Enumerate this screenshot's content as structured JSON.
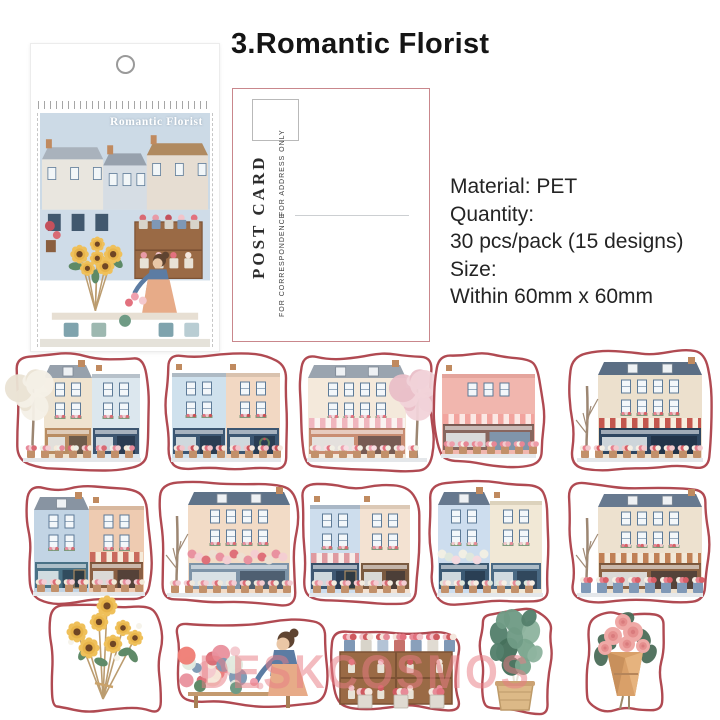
{
  "header": {
    "title": "3.Romantic Florist"
  },
  "package": {
    "label": "Romantic Florist",
    "sky_color": "#ccdae6"
  },
  "postcard": {
    "title": "POST CARD",
    "address_note": "FOR ADDRESS ONLY",
    "correspondence_note": "FOR CORRESPONDENCE",
    "border_color": "#c9878c"
  },
  "details": {
    "material": "Material: PET",
    "quantity_label": "Quantity:",
    "quantity_value": "30 pcs/pack (15 designs)",
    "size_label": "Size:",
    "size_value": "Within 60mm x 60mm"
  },
  "watermark": {
    "text": "DESKCOSMOS",
    "color": "#e87d84"
  },
  "stickers": {
    "outline_color": "#b04a52",
    "items": [
      {
        "name": "flower-shop-white-blossom-tree",
        "type": "shop",
        "x": 12,
        "y": 350,
        "w": 140,
        "h": 124,
        "seed": 1,
        "buildings": [
          {
            "c": "#efe3cf",
            "roof": "mansard",
            "rc": "#97a1ac"
          },
          {
            "c": "#dce7ee",
            "roof": "flat",
            "rc": "#b7c1ca"
          }
        ],
        "shops": [
          "#b98d63",
          "#3d5570"
        ],
        "tree": {
          "type": "white",
          "side": "left"
        },
        "flowers": [
          "#e78b9b",
          "#f4cdd2",
          "#d96a74",
          "#f6ead9",
          "#eef0e8"
        ]
      },
      {
        "name": "twin-storefronts-wreath-door",
        "type": "shop",
        "x": 160,
        "y": 349,
        "w": 132,
        "h": 125,
        "seed": 2,
        "buildings": [
          {
            "c": "#cfe1ed",
            "roof": "flat",
            "rc": "#aebac4"
          },
          {
            "c": "#f2d8c3",
            "roof": "flat",
            "rc": "#d9c2ae"
          }
        ],
        "shops": [
          "#3c5672",
          "#3c5672"
        ],
        "wreath": true,
        "flowers": [
          "#e2717e",
          "#f2c3c9",
          "#ca4f55",
          "#f4e6dd"
        ]
      },
      {
        "name": "pink-awning-shop-blossom-tree",
        "type": "shop",
        "x": 296,
        "y": 350,
        "w": 142,
        "h": 124,
        "seed": 3,
        "buildings": [
          {
            "c": "#f4e9db",
            "roof": "mansard",
            "rc": "#9aa4af"
          }
        ],
        "shops": [
          "#c98d72"
        ],
        "awnings": [
          [
            "#f0b6be",
            "#faf3f0"
          ]
        ],
        "tree": {
          "type": "blossom",
          "side": "right"
        },
        "flowers": [
          "#ef9fae",
          "#f7dde2",
          "#e4717f",
          "#f2efe4"
        ]
      },
      {
        "name": "pink-facade-flower-boutique",
        "type": "shop",
        "x": 430,
        "y": 350,
        "w": 117,
        "h": 120,
        "seed": 4,
        "buildings": [
          {
            "c": "#f1b6ae",
            "roof": "flat",
            "rc": "#e4a49c"
          }
        ],
        "shops": [
          "#88665e"
        ],
        "awnings": [
          [
            "#f2a49e",
            "#fbe8e4"
          ]
        ],
        "doorColor": "#8095aa",
        "flowers": [
          "#f3c9cd",
          "#ee9daa",
          "#f7efe6",
          "#e88795"
        ]
      },
      {
        "name": "red-striped-awning-flower-stall",
        "type": "shop",
        "x": 566,
        "y": 347,
        "w": 148,
        "h": 127,
        "seed": 5,
        "buildings": [
          {
            "c": "#ece0cd",
            "roof": "mansard",
            "rc": "#5b6e84"
          }
        ],
        "shops": [
          "#2e4660"
        ],
        "awnings": [
          [
            "#c4574e",
            "#f6eedf"
          ]
        ],
        "tree": {
          "type": "bare",
          "side": "left"
        },
        "flowers": [
          "#e8828f",
          "#f3c9cc",
          "#d95f66",
          "#f5efe4"
        ]
      },
      {
        "name": "blue-peach-shops-chalkboard",
        "type": "shop",
        "x": 22,
        "y": 482,
        "w": 134,
        "h": 126,
        "seed": 6,
        "buildings": [
          {
            "c": "#c2d4e4",
            "roof": "mansard",
            "rc": "#8894a2"
          },
          {
            "c": "#eecbb1",
            "roof": "flat",
            "rc": "#d8b89e"
          }
        ],
        "shops": [
          "#4a7286",
          "#8a5f43"
        ],
        "awnings": [
          null,
          [
            "#c96a5d",
            "#f5ead9"
          ]
        ],
        "chalkboard": true,
        "flowers": [
          "#e88e9e",
          "#f3cdd3",
          "#dd6b76",
          "#f2ead9"
        ]
      },
      {
        "name": "peach-townhouse-rose-canopy",
        "type": "shop",
        "x": 156,
        "y": 477,
        "w": 146,
        "h": 132,
        "seed": 7,
        "buildings": [
          {
            "c": "#f2dbc6",
            "roof": "mansard",
            "rc": "#5f7389"
          }
        ],
        "shops": [
          "#7e94a8"
        ],
        "roseband": true,
        "rosebandColors": [
          "#e88e9e",
          "#f3cdd3",
          "#dd6b76",
          "#ecdfd2"
        ],
        "tree": {
          "type": "bare",
          "side": "left"
        },
        "flowers": [
          "#e88e9e",
          "#f3cdd3",
          "#dd6b76",
          "#f0e9dc"
        ]
      },
      {
        "name": "blue-shop-pink-awning-menu-board",
        "type": "shop",
        "x": 298,
        "y": 481,
        "w": 124,
        "h": 128,
        "seed": 8,
        "buildings": [
          {
            "c": "#cddded",
            "roof": "flat",
            "rc": "#a9b7c6"
          },
          {
            "c": "#f3e2d2",
            "roof": "flat",
            "rc": "#dcc9b6"
          }
        ],
        "shops": [
          "#3f5873",
          "#7a5a40"
        ],
        "awnings": [
          [
            "#df9aa0",
            "#f7ece8"
          ],
          null
        ],
        "chalkboard": true,
        "flowers": [
          "#e98d9b",
          "#f4cdd2",
          "#d96a74",
          "#f3ecdf"
        ]
      },
      {
        "name": "blue-cream-pair-white-roses",
        "type": "shop",
        "x": 426,
        "y": 477,
        "w": 128,
        "h": 132,
        "seed": 9,
        "buildings": [
          {
            "c": "#cdddee",
            "roof": "mansard",
            "rc": "#66788e"
          },
          {
            "c": "#f1e8d6",
            "roof": "flat",
            "rc": "#dcd2bc"
          }
        ],
        "shops": [
          "#3c5a74",
          "#4a6a84"
        ],
        "roseband": true,
        "rosebandColors": [
          "#f2efe3",
          "#dfe7db",
          "#f6d9de"
        ],
        "flowers": [
          "#f2c6cc",
          "#f7efe4",
          "#e78b98",
          "#dfe8dc"
        ]
      },
      {
        "name": "wooden-shopfront-flower-buckets",
        "type": "shop",
        "x": 566,
        "y": 479,
        "w": 148,
        "h": 130,
        "seed": 10,
        "buildings": [
          {
            "c": "#ede1cf",
            "roof": "mansard",
            "rc": "#67798f"
          }
        ],
        "shops": [
          "#8a6244"
        ],
        "awnings": [
          [
            "#c08055",
            "#f2e8d8"
          ]
        ],
        "potStyle": "bucket",
        "tree": {
          "type": "bare",
          "side": "left"
        },
        "flowers": [
          "#e8828f",
          "#d95f66",
          "#f3c9cc",
          "#f5efe4"
        ]
      },
      {
        "name": "sunflower-bouquet",
        "type": "sunflowers",
        "x": 44,
        "y": 602,
        "w": 122,
        "h": 115,
        "seed": 11
      },
      {
        "name": "florist-arranging-bouquets",
        "type": "florist",
        "x": 170,
        "y": 616,
        "w": 162,
        "h": 94,
        "seed": 12
      },
      {
        "name": "flower-display-cabinet",
        "type": "shelf",
        "x": 328,
        "y": 628,
        "w": 136,
        "h": 86,
        "seed": 13
      },
      {
        "name": "potted-plant-woven-basket",
        "type": "plant",
        "x": 475,
        "y": 606,
        "w": 80,
        "h": 112,
        "seed": 14
      },
      {
        "name": "pink-bouquet-kraft-wrap",
        "type": "bouquet",
        "x": 583,
        "y": 608,
        "w": 84,
        "h": 108,
        "seed": 15
      }
    ]
  }
}
